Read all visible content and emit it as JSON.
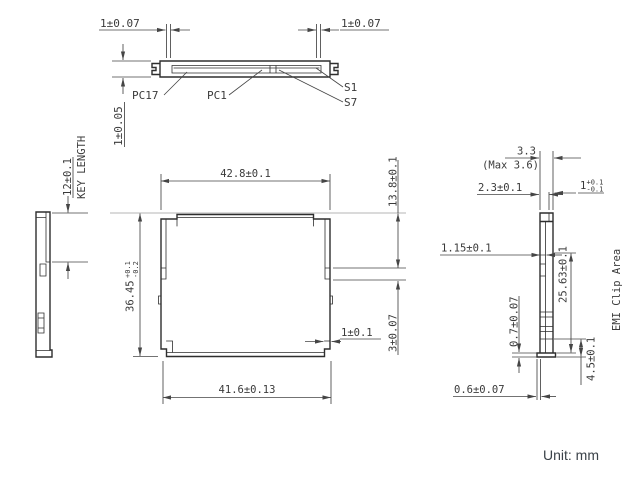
{
  "colors": {
    "line": "#3c3c3c",
    "construction": "#b5b5b5",
    "note_text": "#3b4249",
    "background": "#ffffff"
  },
  "note": {
    "unit": "Unit: mm"
  },
  "edge_view": {
    "dim_left": "1±0.07",
    "dim_right": "1±0.07",
    "dim_thickness": "1±0.05",
    "label_pc17": "PC17",
    "label_pc1": "PC1",
    "label_s1": "S1",
    "label_s7": "S7"
  },
  "side_view_left": {
    "dim_key_length": "12±0.1",
    "caption_key_length": "KEY LENGTH"
  },
  "front_view": {
    "dim_top_width": "42.8±0.1",
    "dim_bottom_width": "41.6±0.13",
    "dim_height": "36.45",
    "dim_height_tol_upper": "+0.1",
    "dim_height_tol_lower": "-0.2",
    "dim_right_depth": "13.8±0.1",
    "dim_right_step": "3±0.07",
    "dim_corner_step": "1±0.1"
  },
  "side_view_right": {
    "dim_overall": "3.3",
    "dim_overall_max": "(Max 3.6)",
    "dim_body": "2.3±0.1",
    "dim_clip": "1",
    "dim_clip_tol_upper": "+0.1",
    "dim_clip_tol_lower": "-0.1",
    "dim_lip": "1.15±0.1",
    "dim_foot_thickness": "0.7±0.07",
    "dim_emi_span": "25.63±0.1",
    "caption_emi": "EMI Clip Area",
    "dim_bottom_span": "4.5±0.1",
    "dim_foot_offset": "0.6±0.07"
  }
}
